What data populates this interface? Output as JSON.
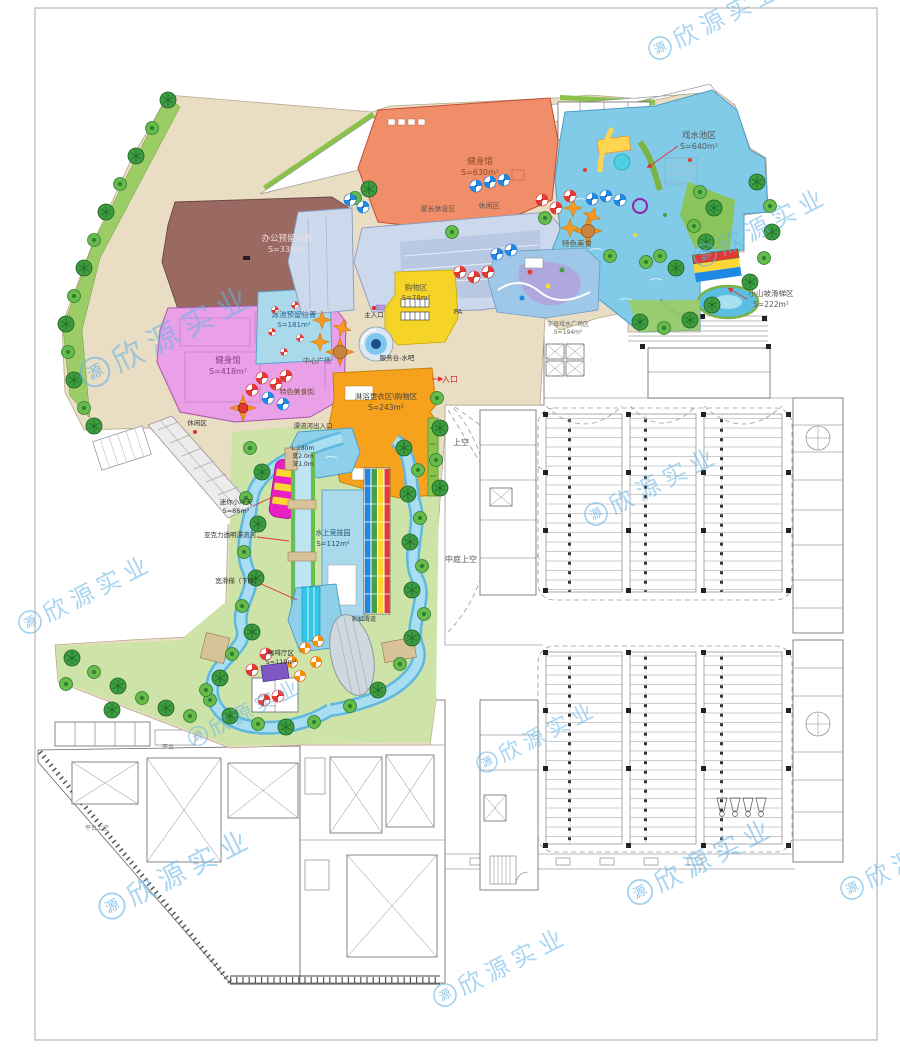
{
  "watermark": {
    "logo_char": "源",
    "text": "欣源实业",
    "color": "#64b2e6",
    "positions": [
      {
        "x": 95,
        "y": 372,
        "rot": -27,
        "scale": 1.3
      },
      {
        "x": 660,
        "y": 48,
        "rot": -27,
        "scale": 1.0
      },
      {
        "x": 705,
        "y": 255,
        "rot": -27,
        "scale": 1.0
      },
      {
        "x": 596,
        "y": 514,
        "rot": -27,
        "scale": 1.0
      },
      {
        "x": 30,
        "y": 622,
        "rot": -27,
        "scale": 1.0
      },
      {
        "x": 198,
        "y": 736,
        "rot": -27,
        "scale": 0.85
      },
      {
        "x": 487,
        "y": 762,
        "rot": -27,
        "scale": 0.9
      },
      {
        "x": 112,
        "y": 906,
        "rot": -27,
        "scale": 1.15
      },
      {
        "x": 640,
        "y": 892,
        "rot": -27,
        "scale": 1.1
      },
      {
        "x": 852,
        "y": 888,
        "rot": -27,
        "scale": 1.0
      },
      {
        "x": 445,
        "y": 995,
        "rot": -27,
        "scale": 1.0
      }
    ]
  },
  "labels": [
    {
      "id": "gym-top-name",
      "t": "健身馆",
      "x": 480,
      "y": 164,
      "s": 8.5,
      "c": "#8a4a2a"
    },
    {
      "id": "gym-top-area",
      "t": "S=630m²",
      "x": 480,
      "y": 175,
      "s": 8,
      "c": "#8a4a2a"
    },
    {
      "id": "splash-pool-name",
      "t": "戏水池区",
      "x": 699,
      "y": 138,
      "s": 8.5,
      "c": "#555"
    },
    {
      "id": "splash-pool-area",
      "t": "S=640m²",
      "x": 699,
      "y": 149,
      "s": 8,
      "c": "#555"
    },
    {
      "id": "office-reserved-name",
      "t": "办公预留位置",
      "x": 287,
      "y": 241,
      "s": 8.5,
      "c": "#f0ded6"
    },
    {
      "id": "office-reserved-area",
      "t": "S=338m²",
      "x": 287,
      "y": 252,
      "s": 8,
      "c": "#f0ded6"
    },
    {
      "id": "gym-left-name",
      "t": "健身馆",
      "x": 228,
      "y": 363,
      "s": 8.5,
      "c": "#8b3a8b"
    },
    {
      "id": "gym-left-area",
      "t": "S=418m²",
      "x": 228,
      "y": 374,
      "s": 8,
      "c": "#8b3a8b"
    },
    {
      "id": "pool-reserved-name",
      "t": "泳池预留位置",
      "x": 294,
      "y": 317,
      "s": 7.5,
      "c": "#2a6496"
    },
    {
      "id": "pool-reserved-area",
      "t": "S=181m²",
      "x": 294,
      "y": 327,
      "s": 7,
      "c": "#2a6496"
    },
    {
      "id": "shop-zone-name",
      "t": "购物区",
      "x": 416,
      "y": 290,
      "s": 7.5,
      "c": "#555"
    },
    {
      "id": "shop-zone-area",
      "t": "S=78m²",
      "x": 416,
      "y": 300,
      "s": 7,
      "c": "#555"
    },
    {
      "id": "parents-rest",
      "t": "家长休息区",
      "x": 438,
      "y": 211,
      "s": 7,
      "c": "#555"
    },
    {
      "id": "rest-area-1",
      "t": "休闲区",
      "x": 489,
      "y": 208,
      "s": 7,
      "c": "#555"
    },
    {
      "id": "food-street-right",
      "t": "特色美食",
      "x": 577,
      "y": 246,
      "s": 7.5,
      "c": "#6b4a2a"
    },
    {
      "id": "food-street-left",
      "t": "特色美食街",
      "x": 297,
      "y": 394,
      "s": 7,
      "c": "#6b4a2a"
    },
    {
      "id": "center-plaza",
      "t": "中心广场",
      "x": 317,
      "y": 363,
      "s": 7,
      "c": "#555"
    },
    {
      "id": "main-entrance",
      "t": "主入口",
      "x": 374,
      "y": 317,
      "s": 6.5,
      "c": "#333"
    },
    {
      "id": "service-bar",
      "t": "服务台-水吧",
      "x": 397,
      "y": 360,
      "s": 6.5,
      "c": "#333"
    },
    {
      "id": "entrance",
      "t": "入口",
      "x": 450,
      "y": 382,
      "s": 8,
      "c": "#cc2222"
    },
    {
      "id": "shower-zone-name",
      "t": "淋浴更衣区\\购物区",
      "x": 386,
      "y": 399,
      "s": 7.5,
      "c": "#444"
    },
    {
      "id": "shower-zone-area",
      "t": "S=243m²",
      "x": 386,
      "y": 410,
      "s": 7.5,
      "c": "#444"
    },
    {
      "id": "river-gate",
      "t": "漂流河出入口",
      "x": 313,
      "y": 428,
      "s": 6.5,
      "c": "#333"
    },
    {
      "id": "river-spec-1",
      "t": "L:180m",
      "x": 303,
      "y": 450,
      "s": 6,
      "c": "#333"
    },
    {
      "id": "river-spec-2",
      "t": "宽2.0m",
      "x": 303,
      "y": 458,
      "s": 6,
      "c": "#333"
    },
    {
      "id": "river-spec-3",
      "t": "深1.0m",
      "x": 303,
      "y": 466,
      "s": 6,
      "c": "#333"
    },
    {
      "id": "mini-slide-name",
      "t": "迷你小冲天",
      "x": 236,
      "y": 504,
      "s": 6.5,
      "c": "#333"
    },
    {
      "id": "mini-slide-area",
      "t": "S=86m²",
      "x": 236,
      "y": 513,
      "s": 6.5,
      "c": "#333"
    },
    {
      "id": "acrylic-river",
      "t": "亚克力透明漂流河",
      "x": 230,
      "y": 537,
      "s": 6.5,
      "c": "#333"
    },
    {
      "id": "wide-slide",
      "t": "宽滑梯（下降）",
      "x": 238,
      "y": 583,
      "s": 6.5,
      "c": "#333"
    },
    {
      "id": "water-sports-name",
      "t": "水上竞技园",
      "x": 333,
      "y": 535,
      "s": 7,
      "c": "#1a5276"
    },
    {
      "id": "water-sports-area",
      "t": "S=112m²",
      "x": 333,
      "y": 546,
      "s": 7,
      "c": "#1a5276"
    },
    {
      "id": "rainbow-slide",
      "t": "彩虹滑道",
      "x": 364,
      "y": 621,
      "s": 6,
      "c": "#333"
    },
    {
      "id": "cafe-name",
      "t": "咖啡厅区",
      "x": 281,
      "y": 655,
      "s": 6.5,
      "c": "#333"
    },
    {
      "id": "cafe-area",
      "t": "S=119m²",
      "x": 281,
      "y": 664,
      "s": 6.5,
      "c": "#333"
    },
    {
      "id": "rest-area-2",
      "t": "休闲区",
      "x": 197,
      "y": 425,
      "s": 6.5,
      "c": "#333"
    },
    {
      "id": "hill-slide-name",
      "t": "小山坡滑梯区",
      "x": 771,
      "y": 296,
      "s": 7.5,
      "c": "#555"
    },
    {
      "id": "hill-slide-area",
      "t": "S=222m²",
      "x": 771,
      "y": 307,
      "s": 7.5,
      "c": "#555"
    },
    {
      "id": "alphabet-plaza-name",
      "t": "字母戏水广场区",
      "x": 568,
      "y": 326,
      "s": 6,
      "c": "#666"
    },
    {
      "id": "alphabet-plaza-area",
      "t": "S=194m²",
      "x": 568,
      "y": 334,
      "s": 6,
      "c": "#666"
    },
    {
      "id": "void-1",
      "t": "上空",
      "x": 461,
      "y": 445,
      "s": 8,
      "c": "#555"
    },
    {
      "id": "atrium-void",
      "t": "中庭上空",
      "x": 461,
      "y": 562,
      "s": 8,
      "c": "#555"
    },
    {
      "id": "pa-room",
      "t": "PA",
      "x": 458,
      "y": 314,
      "s": 7,
      "c": "#333"
    },
    {
      "id": "terrace",
      "t": "平台",
      "x": 168,
      "y": 749,
      "s": 6,
      "c": "#777"
    },
    {
      "id": "terrace-void",
      "t": "平台上空",
      "x": 97,
      "y": 830,
      "s": 6,
      "c": "#777"
    }
  ]
}
